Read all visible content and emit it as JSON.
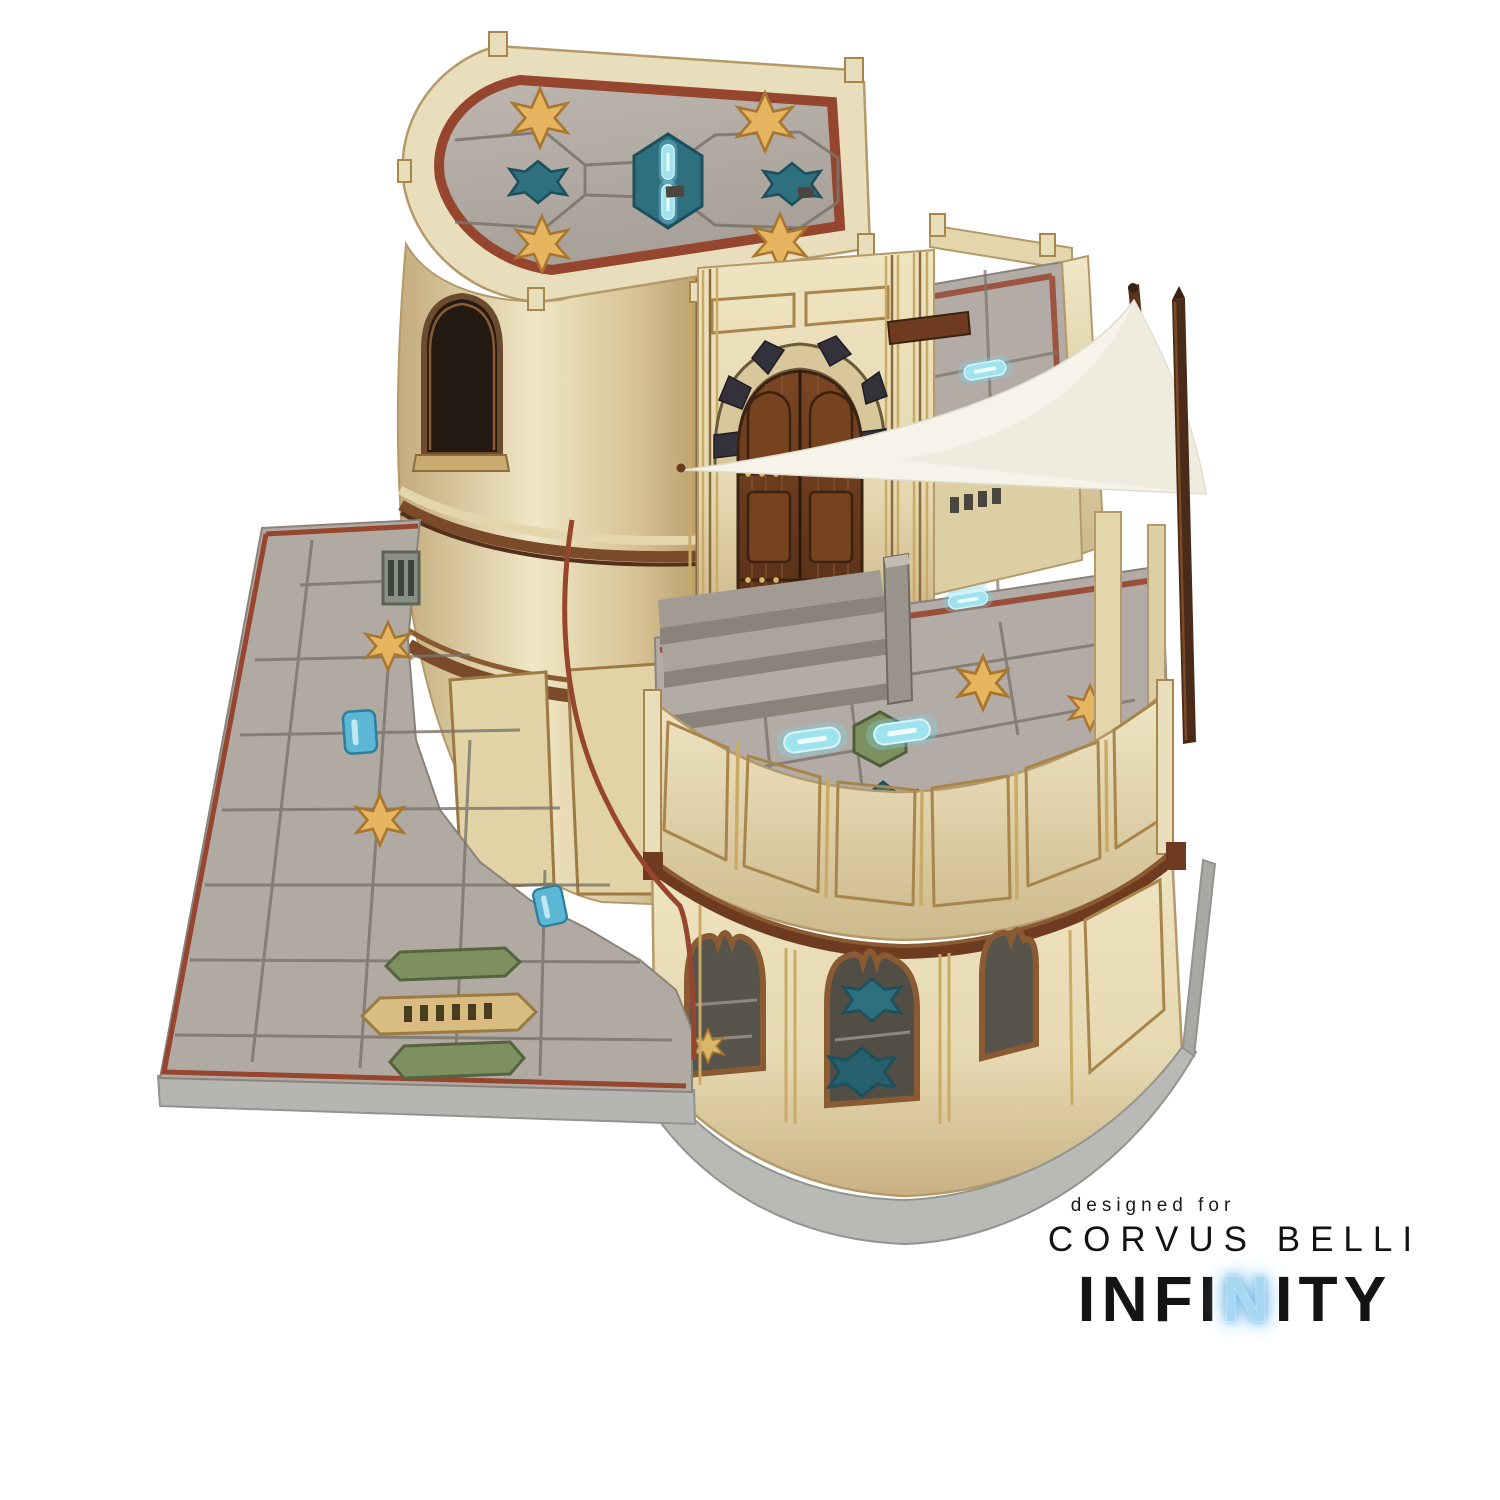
{
  "branding": {
    "designed_for": "designed for",
    "publisher": "CORVUS BELLI",
    "logo_full": "INFINITY",
    "logo_prefix": "INFI",
    "logo_accent": "N",
    "logo_suffix": "ITY"
  },
  "palette": {
    "background": "#ffffff",
    "cream_wall": "#e9debc",
    "cream_light": "#f0e7c6",
    "cream_shadow": "#c9b183",
    "trim_gold": "#a8854a",
    "trim_brown": "#7b4a2a",
    "trim_brown_dark": "#53301c",
    "door_wood": "#6e3d20",
    "door_wood_dark": "#3a2312",
    "arch_block_dark": "#33323a",
    "arch_block_tan": "#d8c79a",
    "roof_tile_grey": "#b3aca6",
    "tile_gap_grey": "#7a746c",
    "red_border": "#96452e",
    "star_gold": "#e5b560",
    "teal_plate": "#2e6f80",
    "glow_cyan": "#9fe3ef",
    "moss_green": "#7d9160",
    "stone_grey": "#b9b9b5",
    "awning_white": "#f6f3ea",
    "logo_black": "#141414",
    "logo_blue": "#a6d8f4"
  }
}
